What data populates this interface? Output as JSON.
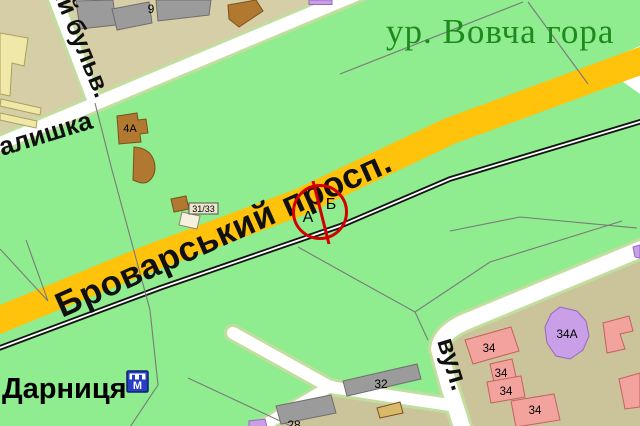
{
  "map": {
    "place_labels": {
      "tract_name": "ур. Вовча гора",
      "station_name": "Дарниця"
    },
    "street_labels": {
      "avenue": "Броварський просп.",
      "boulevard": "ий бульв.",
      "left_street": "алишка",
      "right_street": "вул. "
    },
    "route_marker": {
      "side_a": "А",
      "side_b": "Б"
    },
    "building_labels": {
      "b9": "9",
      "b4a": "4А",
      "b31_33": "31/33",
      "b32": "32",
      "b28": "28",
      "b34_a": "34",
      "b34_b": "34",
      "b34_c": "34",
      "b34_d": "34",
      "b34a": "34А"
    },
    "station_icon_letter": "М",
    "colors": {
      "park_green": "#8FEC8F",
      "road_yellow": "#FFC30B",
      "urban_tan": "#D6CEA6",
      "urban_tan_dark": "#CBC39A",
      "railway_black": "#141414",
      "marker_red": "#D40000",
      "tract_label_green": "#1E8A1E",
      "station_label_red": "#F21500",
      "building_pink": "#F2A39E",
      "building_purple": "#C9A0E8",
      "building_gray": "#9B9B9B",
      "building_brown": "#B0792F",
      "building_yellow": "#EFE8A8",
      "building_cream": "#F5F1DE",
      "building_ochre": "#D9B96A",
      "station_icon_blue": "#2540C4"
    }
  }
}
